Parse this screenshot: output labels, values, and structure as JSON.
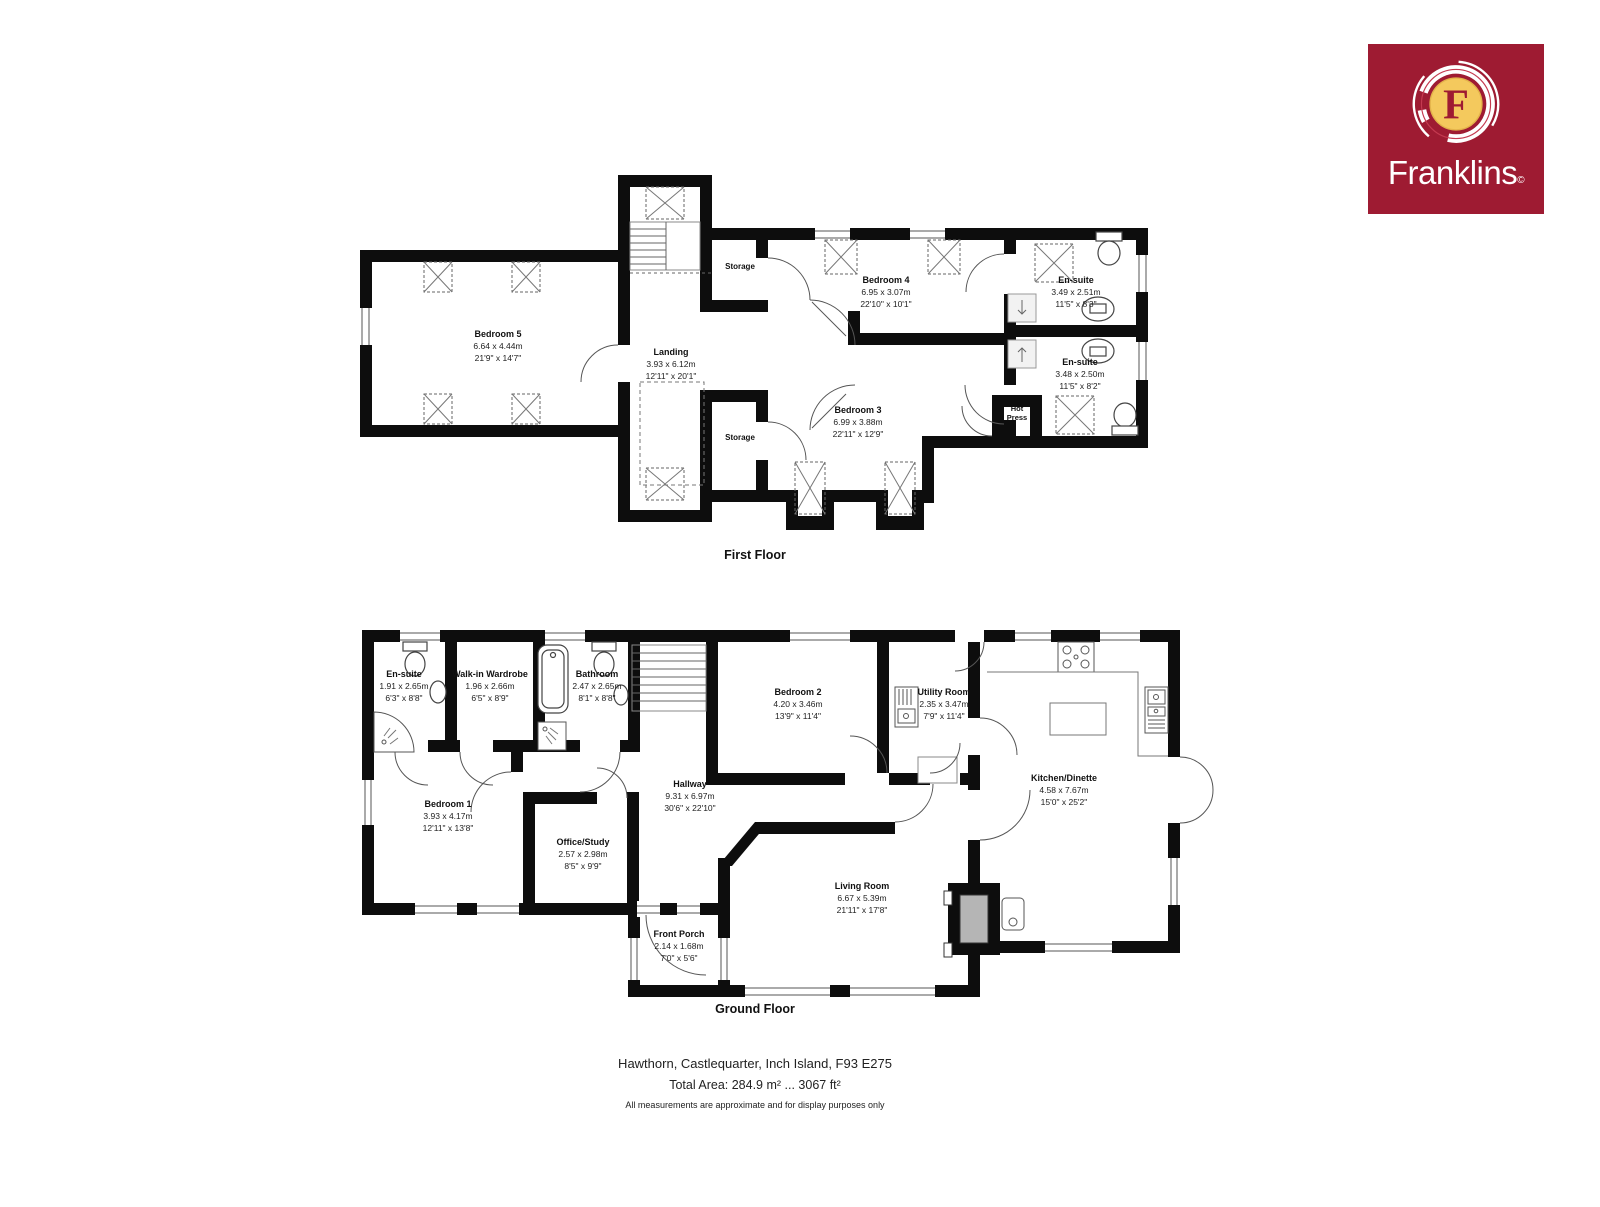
{
  "logo": {
    "brand": "Franklins",
    "mark": "©",
    "letter": "F",
    "bg_color": "#9E1B32",
    "disc_color": "#F4C95D"
  },
  "floors": [
    {
      "label": "First Floor",
      "rooms": [
        {
          "name": "Bedroom 5",
          "metric": "6.64 x 4.44m",
          "imperial": "21'9\" x 14'7\""
        },
        {
          "name": "Landing",
          "metric": "3.93 x 6.12m",
          "imperial": "12'11\" x 20'1\""
        },
        {
          "name": "Storage"
        },
        {
          "name": "Bedroom 4",
          "metric": "6.95 x 3.07m",
          "imperial": "22'10\" x 10'1\""
        },
        {
          "name": "En-suite",
          "metric": "3.49 x 2.51m",
          "imperial": "11'5\" x 8'3\""
        },
        {
          "name": "En-suite",
          "metric": "3.48 x 2.50m",
          "imperial": "11'5\" x 8'2\""
        },
        {
          "name": "Bedroom 3",
          "metric": "6.99 x 3.88m",
          "imperial": "22'11\" x 12'9\""
        },
        {
          "name": "Hot Press"
        },
        {
          "name": "Storage"
        }
      ]
    },
    {
      "label": "Ground Floor",
      "rooms": [
        {
          "name": "En-suite",
          "metric": "1.91 x 2.65m",
          "imperial": "6'3\" x 8'8\""
        },
        {
          "name": "Walk-in Wardrobe",
          "metric": "1.96 x 2.66m",
          "imperial": "6'5\" x 8'9\""
        },
        {
          "name": "Bathroom",
          "metric": "2.47 x 2.65m",
          "imperial": "8'1\" x 8'8\""
        },
        {
          "name": "Bedroom 2",
          "metric": "4.20 x 3.46m",
          "imperial": "13'9\" x 11'4\""
        },
        {
          "name": "Utility Room",
          "metric": "2.35 x 3.47m",
          "imperial": "7'9\" x 11'4\""
        },
        {
          "name": "Kitchen/Dinette",
          "metric": "4.58 x 7.67m",
          "imperial": "15'0\" x 25'2\""
        },
        {
          "name": "Bedroom 1",
          "metric": "3.93 x 4.17m",
          "imperial": "12'11\" x 13'8\""
        },
        {
          "name": "Office/Study",
          "metric": "2.57 x 2.98m",
          "imperial": "8'5\" x 9'9\""
        },
        {
          "name": "Hallway",
          "metric": "9.31 x 6.97m",
          "imperial": "30'6\" x 22'10\""
        },
        {
          "name": "Living Room",
          "metric": "6.67 x 5.39m",
          "imperial": "21'11\" x 17'8\""
        },
        {
          "name": "Front Porch",
          "metric": "2.14 x 1.68m",
          "imperial": "7'0\" x 5'6\""
        }
      ]
    }
  ],
  "footer": {
    "address": "Hawthorn, Castlequarter, Inch Island, F93 E275",
    "total_area": "Total Area: 284.9 m² ... 3067 ft²",
    "disclaimer": "All measurements are approximate and for display purposes only"
  }
}
